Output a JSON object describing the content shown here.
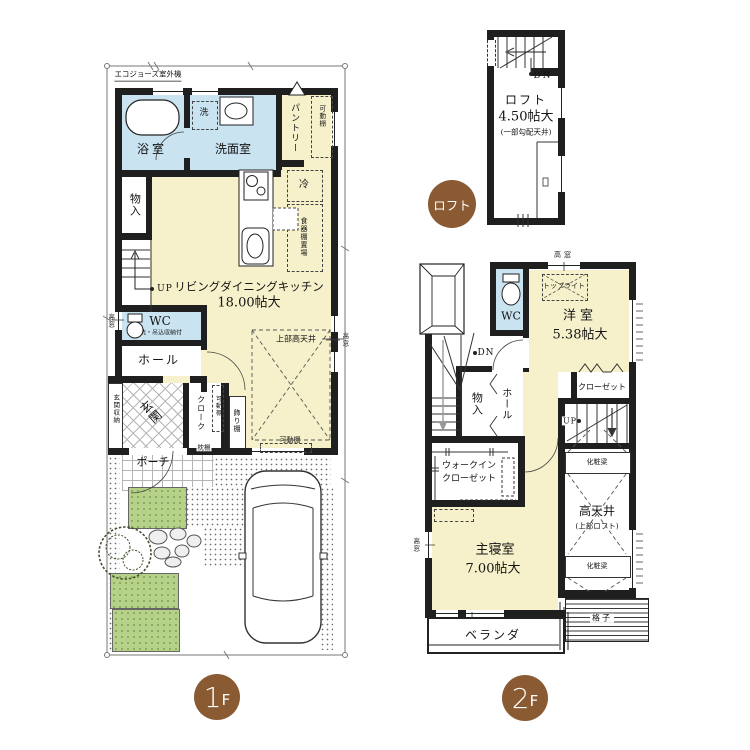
{
  "colors": {
    "wall": "#1f1f1f",
    "room_yellow": "#f6f1ca",
    "wet_blue": "#c9e3f0",
    "grass_green": "#b6d288",
    "badge_brown": "#8a5a33"
  },
  "floor1": {
    "badge_num": "1",
    "badge_suffix": "F",
    "outdoor_unit": "エコジョーズ室外機",
    "bath": "浴室",
    "washer": "洗",
    "washroom": "洗面室",
    "pantry": "パントリー",
    "pantry_shelf": "可動棚",
    "fridge": "冷",
    "cupboard": "食器棚置場",
    "storage": "物入",
    "up": "UP",
    "ldk": "リビングダイニングキッチン",
    "ldk_size": "18.00帖大",
    "upper_high_ceiling": "上部高天井",
    "high_window_left": "高窓",
    "high_window_right": "高窓",
    "wc": "WC",
    "wc_note": "手洗・吊込収納付",
    "hall": "ホール",
    "entrance": "玄関",
    "entrance_storage": "玄関収納",
    "cloak": "クローク",
    "cloak_shelf": "可動棚",
    "pillow_shelf": "枕棚",
    "display_shelf": "飾り棚",
    "movable_shelf": "可動棚",
    "porch": "ポーチ"
  },
  "loft": {
    "badge": "ロフト",
    "dn": "DN",
    "name": "ロフト",
    "size": "4.50帖大",
    "note": "(一部勾配天井)"
  },
  "floor2": {
    "badge_num": "2",
    "badge_suffix": "F",
    "high_window_top": "高窓",
    "skylight": "トップライト",
    "western": "洋室",
    "western_size": "5.38帖大",
    "wc": "WC",
    "dn": "DN",
    "closet": "クローゼット",
    "storage": "物入",
    "hall": "ホール",
    "up": "UP",
    "wic1": "ウォークイン",
    "wic2": "クローゼット",
    "beam": "化粧梁",
    "high_ceiling": "高天井",
    "high_ceiling_note": "(上部ロフト)",
    "master": "主寝室",
    "master_size": "7.00帖大",
    "high_window_left": "高窓",
    "veranda": "ベランダ",
    "lattice": "格子"
  }
}
